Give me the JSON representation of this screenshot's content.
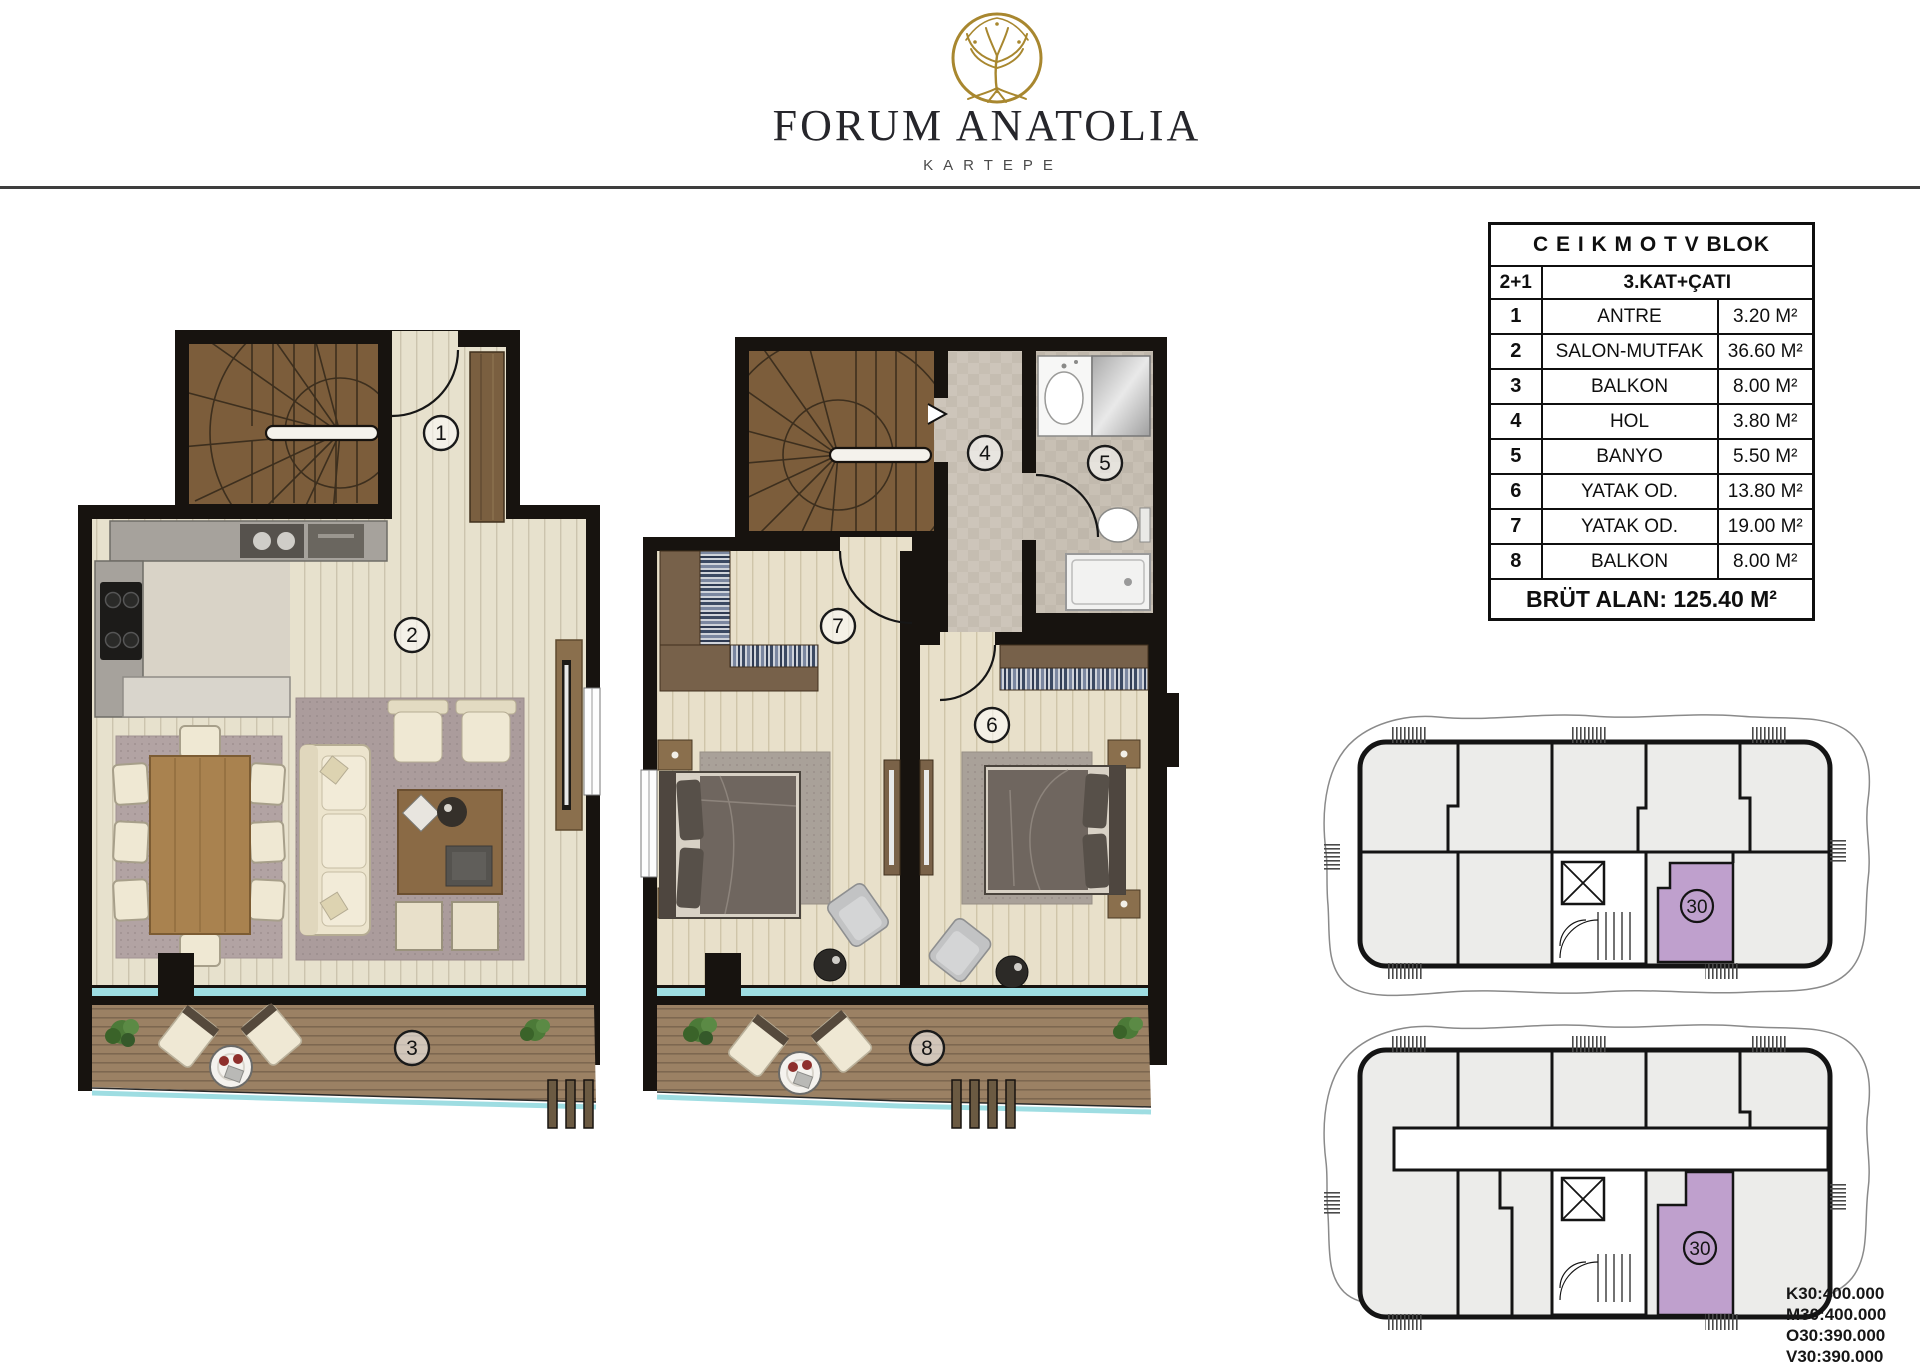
{
  "header": {
    "brand": "FORUM ANATOLIA",
    "subtitle": "KARTEPE",
    "logo": "tree-of-life-logo"
  },
  "unit_table": {
    "block_title": "C E I K M O T V  BLOK",
    "unit_type": "2+1",
    "floor_label": "3.KAT+ÇATI",
    "rows": [
      {
        "no": "1",
        "name": "ANTRE",
        "area": "3.20 M²"
      },
      {
        "no": "2",
        "name": "SALON-MUTFAK",
        "area": "36.60 M²"
      },
      {
        "no": "3",
        "name": "BALKON",
        "area": "8.00 M²"
      },
      {
        "no": "4",
        "name": "HOL",
        "area": "3.80 M²"
      },
      {
        "no": "5",
        "name": "BANYO",
        "area": "5.50 M²"
      },
      {
        "no": "6",
        "name": "YATAK OD.",
        "area": "13.80 M²"
      },
      {
        "no": "7",
        "name": "YATAK OD.",
        "area": "19.00 M²"
      },
      {
        "no": "8",
        "name": "BALKON",
        "area": "8.00 M²"
      }
    ],
    "gross_area": "BRÜT ALAN: 125.40 M²"
  },
  "room_labels": [
    "1",
    "2",
    "3",
    "4",
    "5",
    "6",
    "7",
    "8"
  ],
  "key_plan": {
    "unit_number": "30"
  },
  "price_notes": [
    "K30:400.000",
    "M30:400.000",
    "O30:390.000",
    "V30:390.000"
  ],
  "colors": {
    "glass": "#9EDDE2",
    "highlight_unit": "#BFA0CD",
    "logo_gold": "#A8872F",
    "wall": "#17130F"
  }
}
